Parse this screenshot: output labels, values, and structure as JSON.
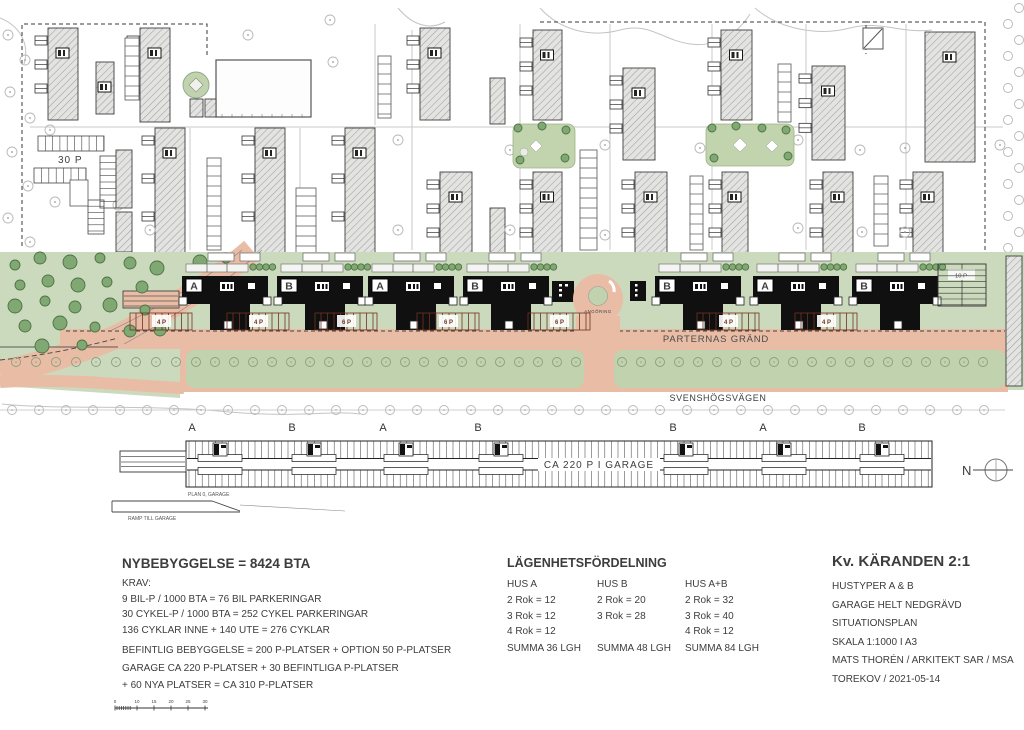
{
  "colors": {
    "road": "#e9bda5",
    "green": "#cbdabc",
    "green_median": "#c0d2ae",
    "tree_dark": "#7fa873",
    "parking_label": "#6e3322"
  },
  "plan": {
    "parking_nw": "30 P",
    "parking_right": "10 P",
    "angoring": "ANGÖRING",
    "street_parternas": "PARTERNAS GRÄND",
    "street_svenshogsvagen": "SVENSHÖGSVÄGEN",
    "buildings": [
      {
        "label": "A"
      },
      {
        "label": "B"
      },
      {
        "label": "A"
      },
      {
        "label": "B"
      },
      {
        "label": "B"
      },
      {
        "label": "A"
      },
      {
        "label": "B"
      }
    ],
    "parking_groups": [
      "4 P",
      "4 P",
      "6 P",
      "6 P",
      "6 P",
      "4 P",
      "4 P"
    ]
  },
  "garage": {
    "title": "CA 220 P I GARAGE",
    "sections": [
      "A",
      "B",
      "A",
      "B",
      "B",
      "A",
      "B"
    ],
    "plan_label": "PLAN 0, GARAGE",
    "ramp_label": "RAMP TILL GARAGE"
  },
  "compass": {
    "label": "N"
  },
  "scalebar": {
    "labels": [
      "0",
      "10",
      "15",
      "20",
      "25",
      "30"
    ]
  },
  "stats": {
    "title": "NYBEBYGGELSE = 8424 BTA",
    "lines": [
      "KRAV:",
      "9 BIL-P / 1000 BTA = 76 BIL PARKERINGAR",
      "30 CYKEL-P / 1000 BTA = 252 CYKEL PARKERINGAR",
      "136 CYKLAR INNE + 140 UTE = 276 CYKLAR"
    ],
    "lines2": [
      "BEFINTLIG BEBYGGELSE = 200 P-PLATSER + OPTION 50 P-PLATSER",
      "GARAGE CA 220 P-PLATSER + 30 BEFINTLIGA P-PLATSER",
      "+ 60 NYA PLATSER = CA 310 P-PLATSER"
    ]
  },
  "apartments": {
    "title": "LÄGENHETSFÖRDELNING",
    "columns": [
      {
        "header": "HUS A",
        "rows": [
          "2 Rok = 12",
          "3 Rok = 12",
          "4 Rok = 12"
        ],
        "summa": "SUMMA 36 LGH"
      },
      {
        "header": "HUS B",
        "rows": [
          "2 Rok = 20",
          "3 Rok = 28"
        ],
        "summa": "SUMMA 48 LGH"
      },
      {
        "header": "HUS A+B",
        "rows": [
          "2 Rok = 32",
          "3 Rok = 40",
          "4 Rok = 12"
        ],
        "summa": "SUMMA 84 LGH"
      }
    ]
  },
  "titleblock": {
    "title": "Kv. KÄRANDEN 2:1",
    "lines": [
      "HUSTYPER A & B",
      "GARAGE HELT NEDGRÄVD",
      "SITUATIONSPLAN",
      "SKALA 1:1000 I A3",
      "MATS THORÉN / ARKITEKT SAR / MSA",
      "TOREKOV / 2021-05-14"
    ]
  }
}
